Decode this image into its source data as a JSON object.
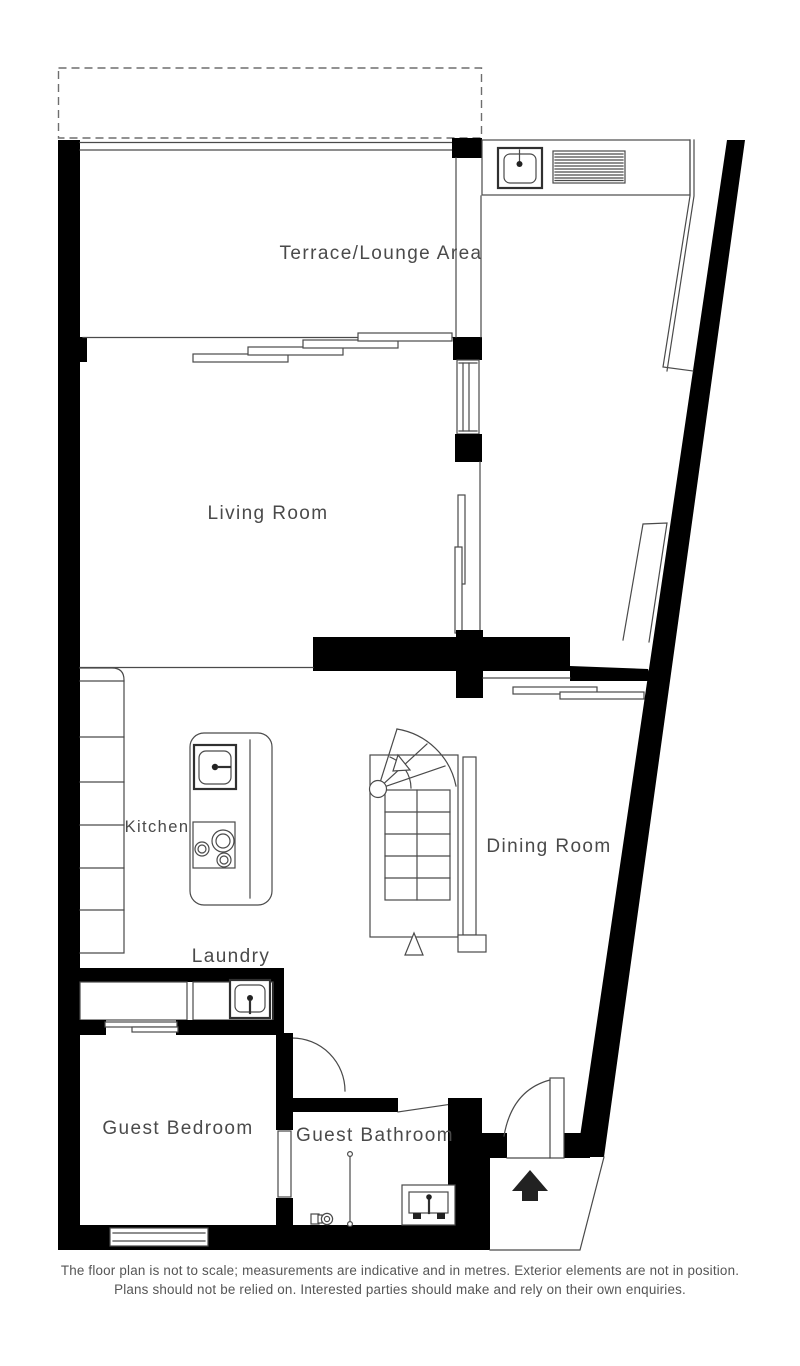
{
  "plan": {
    "title": "Floor plan",
    "rooms": {
      "terrace": {
        "label": "Terrace/Lounge Area"
      },
      "living": {
        "label": "Living Room"
      },
      "kitchen": {
        "label": "Kitchen"
      },
      "dining": {
        "label": "Dining Room"
      },
      "laundry": {
        "label": "Laundry"
      },
      "bedroom": {
        "label": "Guest Bedroom"
      },
      "bathroom": {
        "label": "Guest Bathroom"
      }
    },
    "fixtures": {
      "terrace_sink": "sink-icon",
      "bbq_grill": "grill-icon",
      "kitchen_sink": "sink-icon",
      "hob": "hob-3-burner-icon",
      "laundry_sink": "sink-icon",
      "shower": "shower-rail-icon",
      "toilet": "toilet-icon",
      "vanity": "vanity-basin-icon",
      "staircase": "winder-staircase",
      "entrance_arrow": "entrance-arrow-up-icon"
    },
    "colors": {
      "wall": "#000000",
      "line": "#4a4a4a",
      "text": "#4a4a4a",
      "dashed_boundary": "#6e6e6e",
      "background": "#ffffff"
    },
    "disclaimer": {
      "line1": "The floor plan is not to scale; measurements are indicative and in metres. Exterior elements are not in position.",
      "line2": "Plans should not be relied on. Interested parties should make and rely on their own enquiries."
    }
  }
}
